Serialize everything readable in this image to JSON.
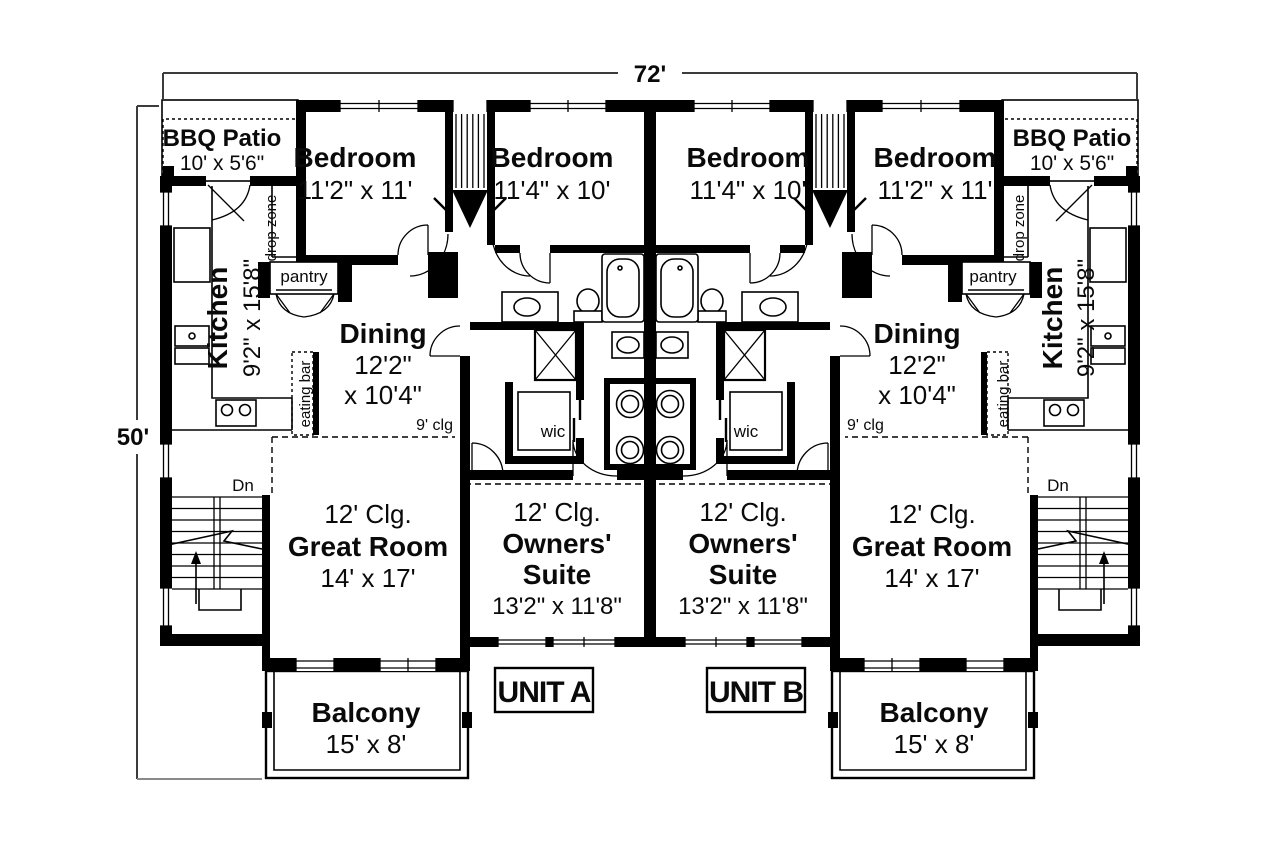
{
  "plan": {
    "overall_width": "72'",
    "overall_depth": "50'",
    "unit_a_label": "UNIT A",
    "unit_b_label": "UNIT B"
  },
  "rooms": {
    "bbq_patio": {
      "name": "BBQ Patio",
      "size": "10' x 5'6\""
    },
    "bedroom_outer": {
      "name": "Bedroom",
      "size": "11'2\" x 11'"
    },
    "bedroom_inner": {
      "name": "Bedroom",
      "size": "11'4\" x 10'"
    },
    "kitchen": {
      "name": "Kitchen",
      "size": "9'2\" x 15'8\""
    },
    "dining": {
      "name": "Dining",
      "size_line1": "12'2\"",
      "size_line2": "x 10'4\""
    },
    "great_room": {
      "ceiling": "12' Clg.",
      "name": "Great Room",
      "size": "14' x 17'"
    },
    "owners_suite": {
      "ceiling": "12' Clg.",
      "name_line1": "Owners'",
      "name_line2": "Suite",
      "size": "13'2\" x 11'8\""
    },
    "balcony": {
      "name": "Balcony",
      "size": "15' x 8'"
    },
    "pantry_label": "pantry",
    "drop_zone_label": "drop zone",
    "eating_bar_label": "eating bar",
    "wic_label": "wic",
    "ceiling_note": "9' clg",
    "stairs_down_label": "Dn"
  },
  "colors": {
    "ink": "#000000",
    "paper": "#ffffff",
    "dimension_line": "#3c3c3c"
  }
}
